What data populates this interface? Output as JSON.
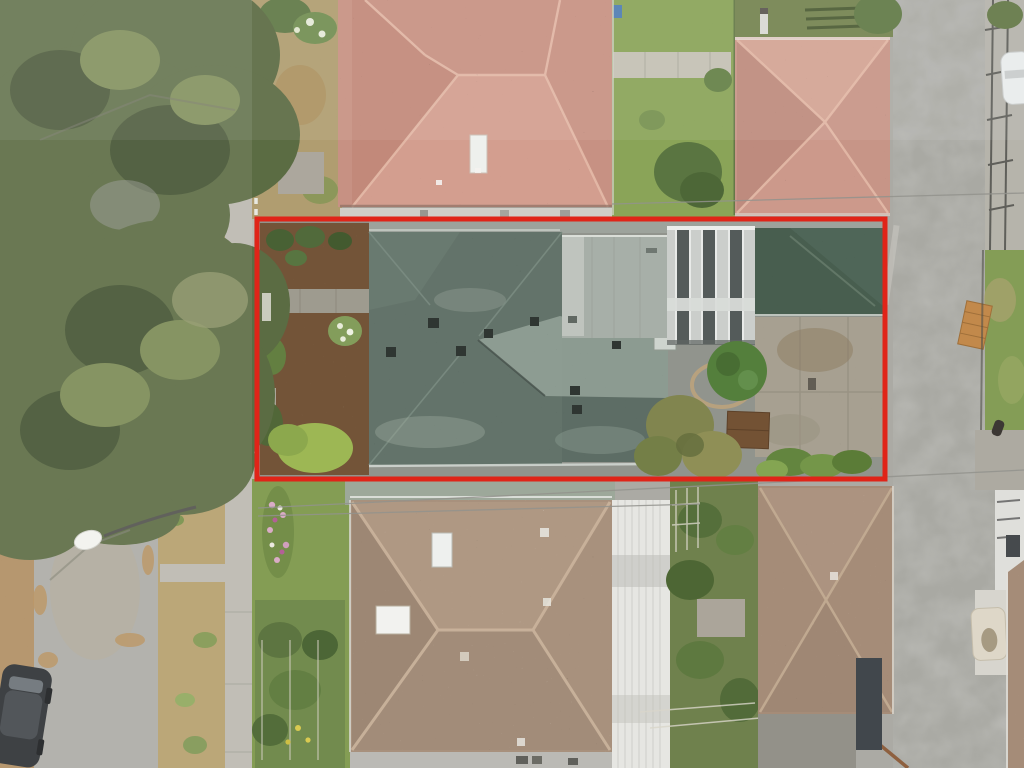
{
  "scene": {
    "kind": "aerial-drone-photo",
    "contains_text": false
  },
  "annotation": {
    "shape": "rectangle",
    "purpose": "property-boundary-highlight",
    "x": 257,
    "y": 219,
    "width": 628,
    "height": 260,
    "stroke_width": 5
  },
  "palette": {
    "redOutline": "#e02418",
    "baseGround": "#a8a7a1",
    "roadRight": "#a6a6a0",
    "sidewalk": "#b9b6ad",
    "leafStrip": "#ad8450",
    "leafDrift": "#b58a52",
    "boulevardDry": "#b39b66",
    "lawn": "#86a152",
    "lawnDark": "#6f8a44",
    "canopy": "#55663c",
    "canopyDark": "#3d4c2a",
    "canopyLight": "#76854d",
    "terracotta": "#c58d7e",
    "terracottaLight": "#d29b8b",
    "terraRidge": "#e3b8a5",
    "pinkRoof": "#c59183",
    "subjectRoof": "#5d6e64",
    "subjectRoofLight": "#8e9c92",
    "roofEdgeWhite": "#d3d8d2",
    "flatRoof": "#a4aca5",
    "carportLight": "#c9cdc9",
    "carportDark": "#4e5554",
    "garageGreen": "#415848",
    "patio": "#a49d8d",
    "mulch": "#6e4e30",
    "pathGray": "#9b978b",
    "bottomRoof": "#a58d78",
    "bottomRoofRidge": "#c9b199",
    "whiteRoof": "#e5e5e1",
    "brRoof": "#a28873",
    "darkFlat": "#3a4045",
    "carBody": "#24272a",
    "carWhite": "#e9ecec",
    "bench": "#c08544",
    "mattress": "#ddd6c6",
    "wire": "#8e8e88",
    "fenceWhite": "#e8e8e0",
    "shedBrown": "#6e4b2c",
    "planterPot": "#b9a078",
    "bushGreen": "#4e7a35"
  }
}
